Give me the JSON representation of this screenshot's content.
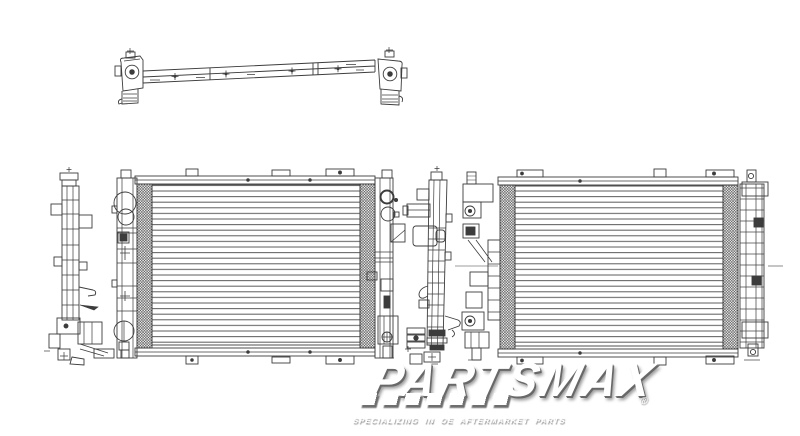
{
  "image": {
    "background_color": "#ffffff",
    "line_color": "#2e2e2e",
    "fin_line_color": "#4f4f4f"
  },
  "watermark": {
    "brand": "PARTSMAX",
    "registered": "®",
    "tagline": "SPECIALIZING IN OE AFTERMARKET PARTS",
    "text_color": "#ffffff",
    "shadow_color": "#6e6e6e"
  }
}
